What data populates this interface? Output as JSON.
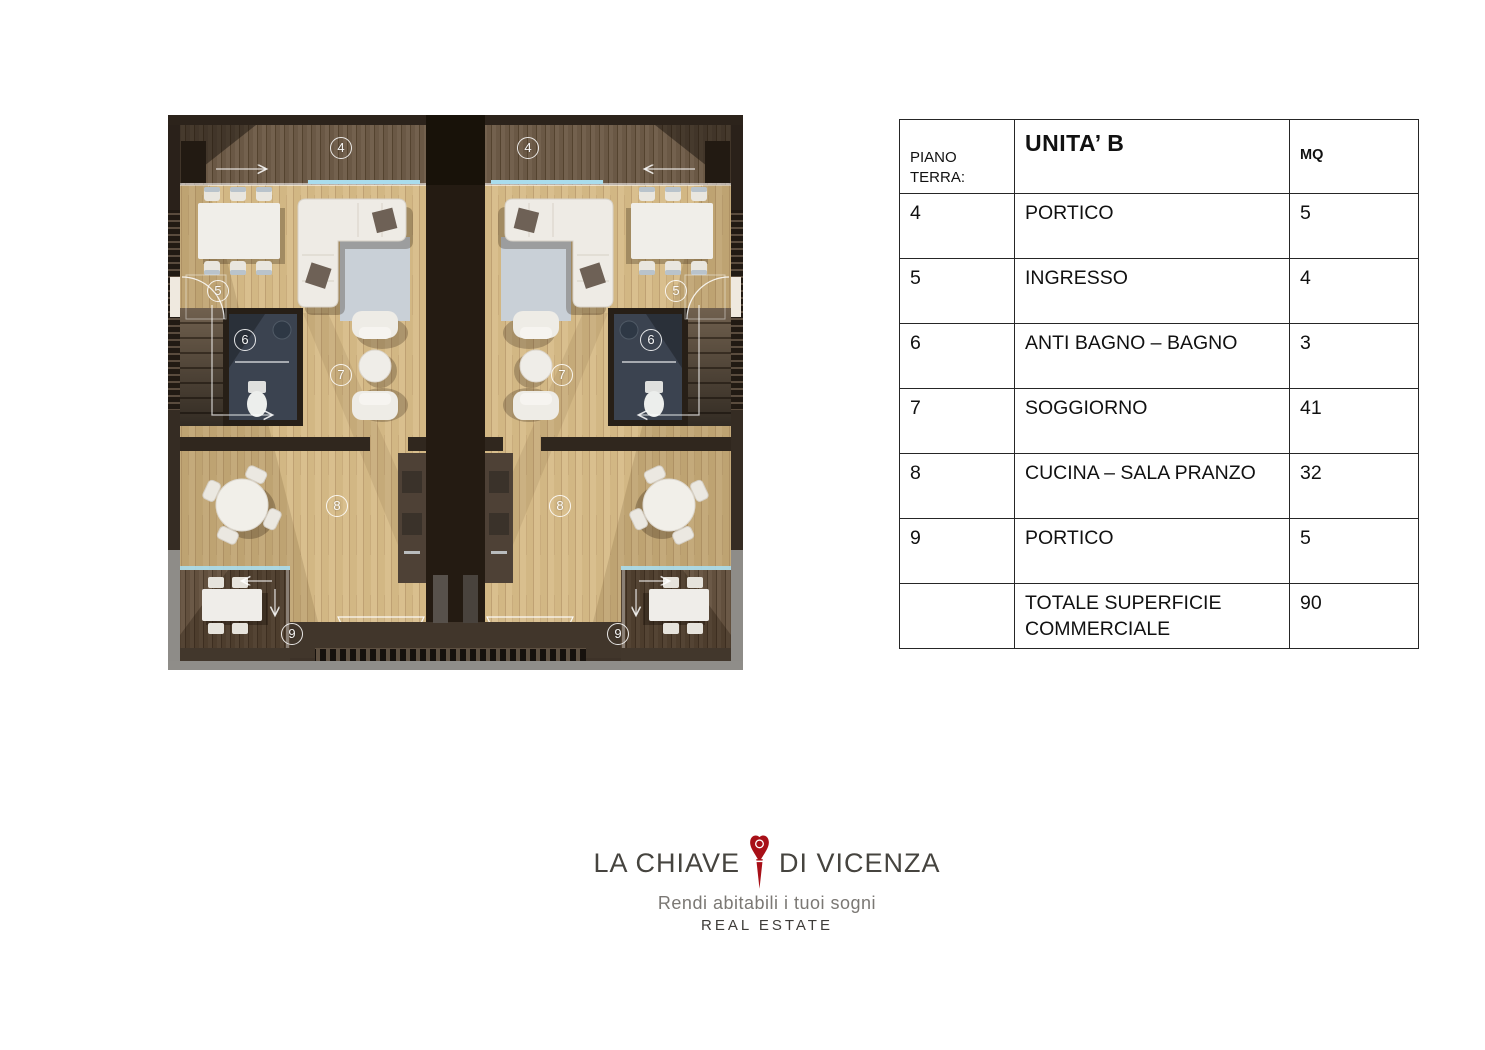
{
  "plan": {
    "caption": "Pianta piano terra — due unità",
    "markers": [
      {
        "id": "portico-nord-left",
        "label": "4"
      },
      {
        "id": "portico-nord-right",
        "label": "4"
      },
      {
        "id": "ingresso-left",
        "label": "5"
      },
      {
        "id": "ingresso-right",
        "label": "5"
      },
      {
        "id": "bagno-left",
        "label": "6"
      },
      {
        "id": "bagno-right",
        "label": "6"
      },
      {
        "id": "soggiorno-left",
        "label": "7"
      },
      {
        "id": "soggiorno-right",
        "label": "7"
      },
      {
        "id": "cucina-left",
        "label": "8"
      },
      {
        "id": "cucina-right",
        "label": "8"
      },
      {
        "id": "portico-sud-left",
        "label": "9"
      },
      {
        "id": "portico-sud-right",
        "label": "9"
      }
    ]
  },
  "table": {
    "header": {
      "floor": "PIANO TERRA:",
      "unit": "UNITA’ B",
      "mq": "MQ"
    },
    "rows": [
      {
        "num": "4",
        "room": "PORTICO",
        "mq": "5"
      },
      {
        "num": "5",
        "room": "INGRESSO",
        "mq": "4"
      },
      {
        "num": "6",
        "room": "ANTI BAGNO – BAGNO",
        "mq": "3"
      },
      {
        "num": "7",
        "room": "SOGGIORNO",
        "mq": "41"
      },
      {
        "num": "8",
        "room": "CUCINA – SALA PRANZO",
        "mq": "32"
      },
      {
        "num": "9",
        "room": "PORTICO",
        "mq": "5"
      },
      {
        "num": "",
        "room": "TOTALE SUPERFICIE COMMERCIALE",
        "mq": "90"
      }
    ]
  },
  "logo": {
    "name_left": "LA CHIAVE",
    "name_right": "DI VICENZA",
    "tagline": "Rendi abitabili i tuoi sogni",
    "subtitle": "REAL ESTATE",
    "accent": "#a81018"
  }
}
